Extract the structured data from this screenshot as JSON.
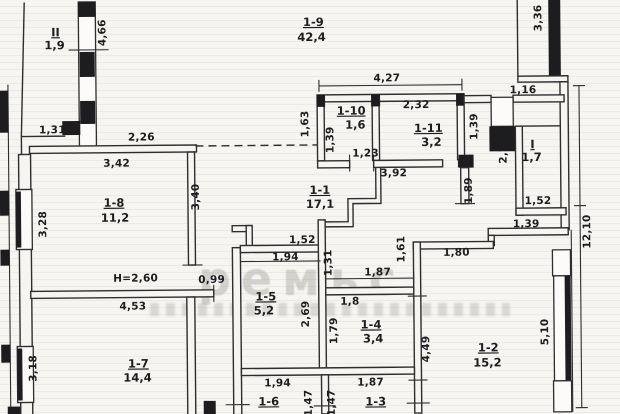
{
  "document": {
    "type": "scanned apartment floor plan",
    "height_note": "H=2,60",
    "watermark": {
      "line1": "ремьс"
    }
  },
  "rooms": {
    "r19": {
      "id": "1-9",
      "area": "42,4"
    },
    "r110": {
      "id": "1-10",
      "area": "1,6"
    },
    "r111": {
      "id": "1-11",
      "area": "3,2"
    },
    "rI": {
      "id": "I",
      "area": "1,7"
    },
    "rII": {
      "id": "II",
      "area": "1,9"
    },
    "r18": {
      "id": "1-8",
      "area": "11,2"
    },
    "r11": {
      "id": "1-1",
      "area": "17,1"
    },
    "r15": {
      "id": "1-5",
      "area": "5,2"
    },
    "r14": {
      "id": "1-4",
      "area": "3,4"
    },
    "r17": {
      "id": "1-7",
      "area": "14,4"
    },
    "r12": {
      "id": "1-2",
      "area": "15,2"
    },
    "r16": {
      "id": "1-6",
      "area": ""
    },
    "r13": {
      "id": "1-3",
      "area": ""
    }
  },
  "dims": {
    "d466": "4,66",
    "d131a": "1,31",
    "d226": "2,26",
    "d342": "3,42",
    "d328": "3,28",
    "d340": "3,40",
    "d427": "4,27",
    "d232": "2,32",
    "d163": "1,63",
    "d139a": "1,39",
    "d123": "1,23",
    "d392": "3,92",
    "d139b": "1,39",
    "d336": "3,36",
    "d116": "1,16",
    "d220": "2,20",
    "d152a": "1,52",
    "d139c": "1,39",
    "d1210": "12,10",
    "d189": "1,89",
    "d180": "1,80",
    "d161": "1,61",
    "d152b": "1,52",
    "d194a": "1,94",
    "d131b": "1,31",
    "d099": "0,99",
    "d187a": "1,87",
    "d18": "1,8",
    "d269": "2,69",
    "d179": "1,79",
    "d453": "4,53",
    "d318": "3,18",
    "d449": "4,49",
    "d510": "5,10",
    "d194b": "1,94",
    "d187b": "1,87",
    "d147a": "1,47",
    "d147b": "1,47"
  }
}
